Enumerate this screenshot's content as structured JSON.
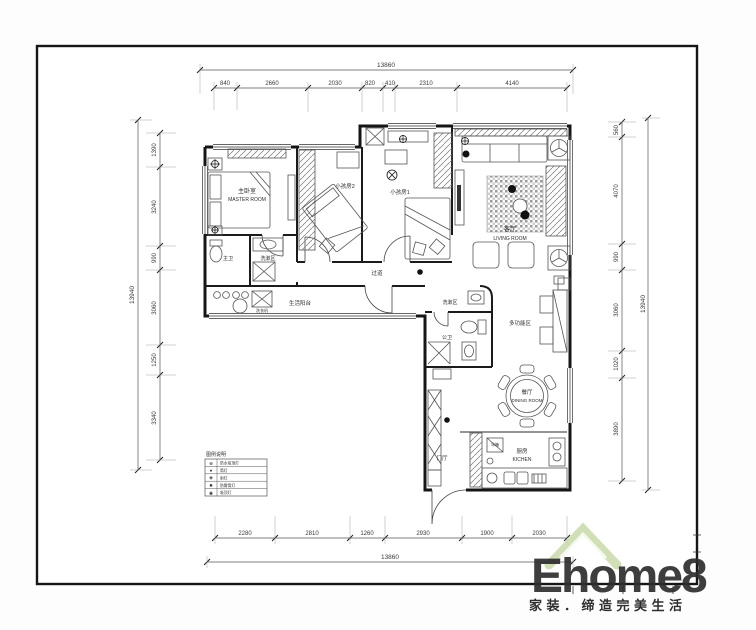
{
  "dims": {
    "top": {
      "overall": "13860",
      "segments": [
        "840",
        "2660",
        "2030",
        "820",
        "410",
        "2310",
        "4140"
      ]
    },
    "bottom": {
      "overall": "13860",
      "segments": [
        "2280",
        "2810",
        "1260",
        "2930",
        "1900",
        "2030"
      ]
    },
    "left": {
      "overall": "13940",
      "segments": [
        "1390",
        "3240",
        "990",
        "3060",
        "1250",
        "3340"
      ]
    },
    "right": {
      "overall": "13940",
      "segments": [
        "560",
        "4070",
        "990",
        "3060",
        "1020",
        "3890"
      ]
    }
  },
  "rooms": {
    "master": {
      "cn": "主卧室",
      "en": "MASTER ROOM"
    },
    "kids2": {
      "cn": "小孩房2"
    },
    "kids1": {
      "cn": "小孩房1"
    },
    "living": {
      "cn": "客厅",
      "en": "LIVING ROOM"
    },
    "master_bath": {
      "cn": "主卫"
    },
    "wash1": {
      "cn": "洗漱区"
    },
    "corridor": {
      "cn": "过道"
    },
    "balcony": {
      "cn": "生活阳台"
    },
    "wash2": {
      "cn": "洗漱区"
    },
    "public_bath": {
      "cn": "公卫"
    },
    "multi": {
      "cn": "多功能区"
    },
    "dining": {
      "cn": "餐厅",
      "en": "DINING ROOM"
    },
    "kitchen": {
      "cn": "厨房",
      "en": "KICHEN"
    },
    "foyer": {
      "cn": "门厅"
    }
  },
  "furniture_labels": {
    "fridge": "冰箱",
    "washer": "洗衣机"
  },
  "legend": {
    "title": "图例说明",
    "rows": [
      {
        "symbol": "⊕",
        "label": "防水吸顶灯"
      },
      {
        "symbol": "●",
        "label": "筒灯"
      },
      {
        "symbol": "✚",
        "label": "射灯"
      },
      {
        "symbol": "✸",
        "label": "防雾筒灯"
      },
      {
        "symbol": "◉",
        "label": "吸顶灯"
      }
    ]
  },
  "watermark": {
    "brand": "Ehome8",
    "slogan": "家装．缔造完美生活",
    "brand_color": "#f8cba6",
    "roof_color": "#ccdcae",
    "slogan_color": "#b9cf96"
  }
}
